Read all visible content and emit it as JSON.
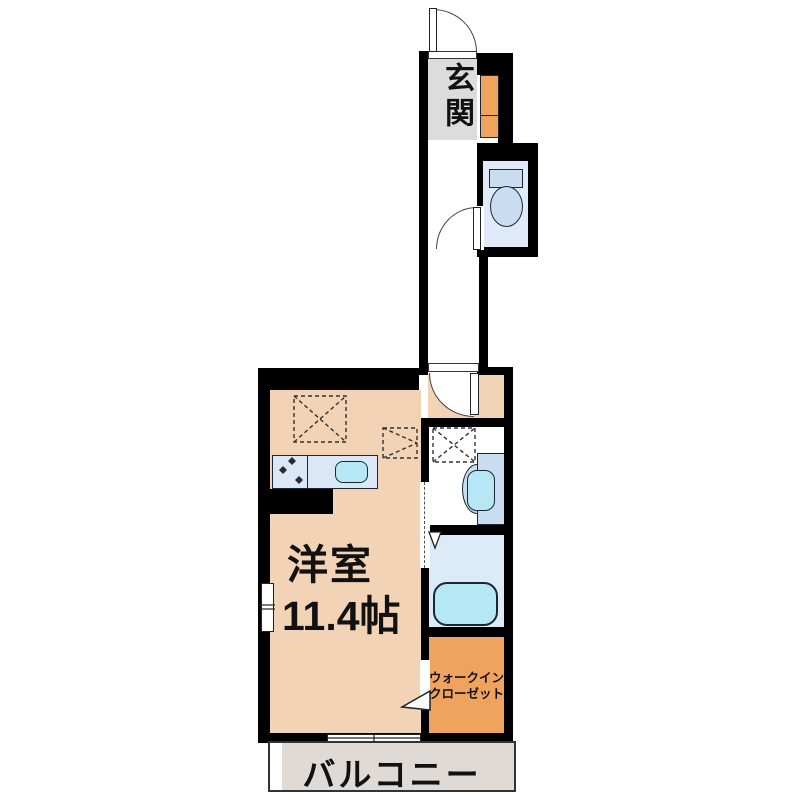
{
  "floor_plan": {
    "rooms": {
      "genkan": {
        "label": "玄関"
      },
      "main_room": {
        "label": "洋室",
        "size": "11.4帖"
      },
      "walk_in_closet": {
        "line1": "ウォークイン",
        "line2": "クローゼット"
      },
      "balcony": {
        "label": "バルコニー"
      }
    },
    "colors": {
      "wall": "#000000",
      "room-peach": "#f2d3b5",
      "genkan-gray": "#dcdcdc",
      "closet-orange": "#efa35f",
      "bath-floor": "#dcebf8",
      "toilet-floor": "#e0eaf8",
      "fixture-blue": "#c9dcf0",
      "water-cyan": "#b5e8f4",
      "counter-blue": "#d9e7f6",
      "balcony-gray": "#dfdad6"
    }
  }
}
